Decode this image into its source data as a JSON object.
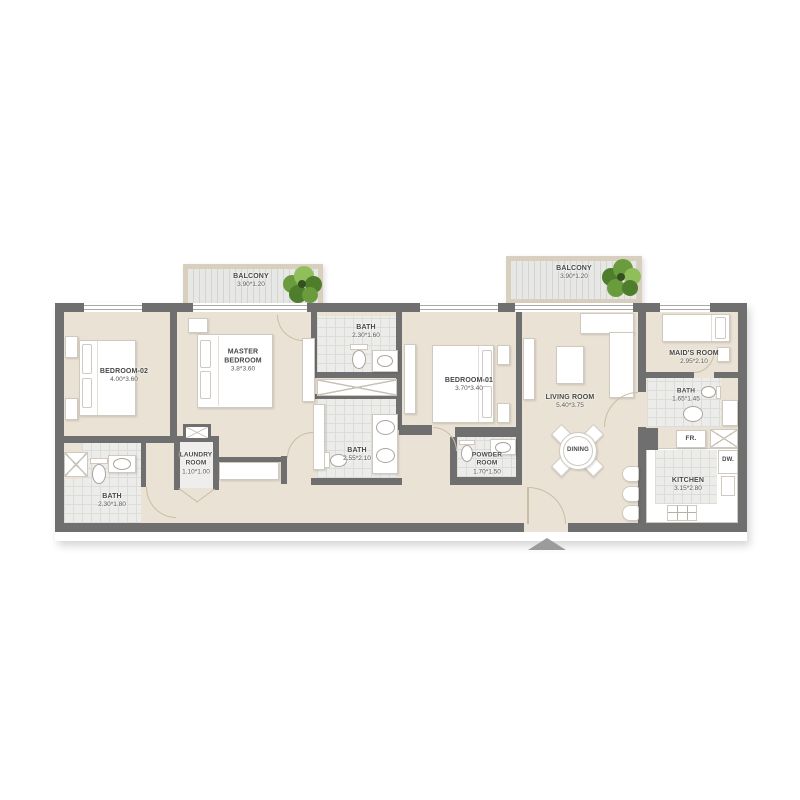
{
  "plan": {
    "rooms": {
      "balcony_left": {
        "name": "BALCONY",
        "dims": "3.90*1.20"
      },
      "balcony_right": {
        "name": "BALCONY",
        "dims": "3.90*1.20"
      },
      "bedroom_02": {
        "name": "BEDROOM-02",
        "dims": "4.00*3.60"
      },
      "master_bedroom": {
        "name": "MASTER BEDROOM",
        "dims": "3.8*3.60"
      },
      "bath_top": {
        "name": "BATH",
        "dims": "2.30*1.60"
      },
      "bath_mid": {
        "name": "BATH",
        "dims": "2.55*2.10"
      },
      "bath_left": {
        "name": "BATH",
        "dims": "2.30*1.80"
      },
      "laundry": {
        "name": "LAUNDRY ROOM",
        "dims": "1.10*1.00"
      },
      "bedroom_01": {
        "name": "BEDROOM-01",
        "dims": "3.70*3.40"
      },
      "powder_room": {
        "name": "POWDER ROOM",
        "dims": "1.70*1.50"
      },
      "living_room": {
        "name": "LIVING ROOM",
        "dims": "5.40*3.75"
      },
      "dining": {
        "name": "DINING"
      },
      "maids_room": {
        "name": "MAID'S ROOM",
        "dims": "2.95*2.10"
      },
      "bath_maid": {
        "name": "BATH",
        "dims": "1.65*1.45"
      },
      "kitchen": {
        "name": "KITCHEN",
        "dims": "3.15*2.80"
      },
      "fridge": {
        "label": "FR."
      },
      "dishwasher": {
        "label": "DW."
      }
    },
    "colors": {
      "wall": "#6f6f6f",
      "floor": "#eae2d4",
      "tile": "#ececea",
      "tile_line": "#dcdcd8",
      "balcony_frame": "#d9cfbf",
      "furn_border": "#cfc9bf",
      "label": "#474747",
      "arc": "#c9bda6",
      "arrow": "#9b9b9b",
      "plant_dark": "#4e7d2b",
      "plant_mid": "#6a9c3d",
      "plant_light": "#8fbe5a"
    }
  }
}
